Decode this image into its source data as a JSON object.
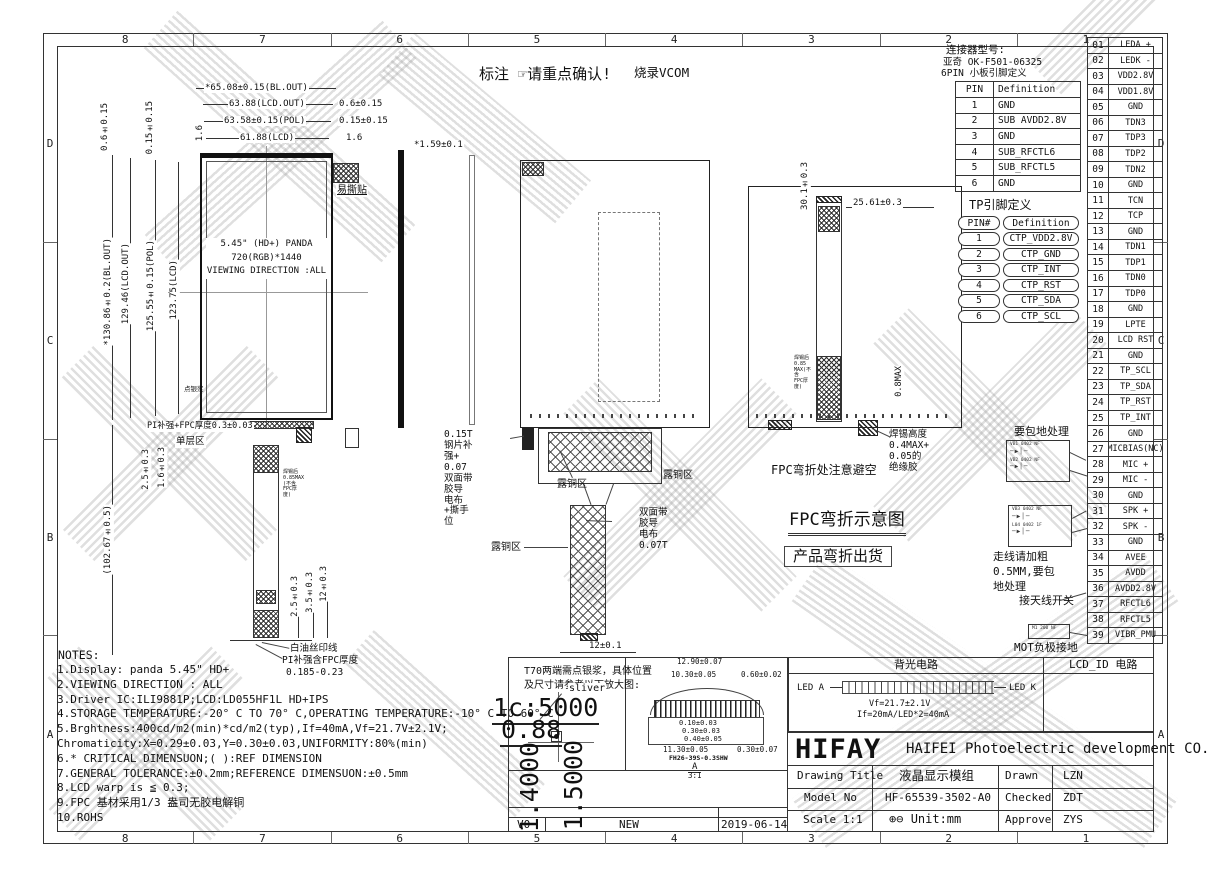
{
  "frame": {
    "cols": [
      "8",
      "7",
      "6",
      "5",
      "4",
      "3",
      "2",
      "1"
    ],
    "rows": [
      "D",
      "C",
      "B",
      "A"
    ]
  },
  "banner": {
    "label": "标注",
    "hand": "☞",
    "confirm": "请重点确认!",
    "vcom": "烧录VCOM"
  },
  "connector": {
    "t1": "连接器型号:",
    "t2": "亚奇 OK-F501-06325",
    "t3": "6PIN 小板引脚定义",
    "h1": "PIN",
    "h2": "Definition",
    "rows": [
      [
        "1",
        "GND"
      ],
      [
        "2",
        "SUB AVDD2.8V"
      ],
      [
        "3",
        "GND"
      ],
      [
        "4",
        "SUB_RFCTL6"
      ],
      [
        "5",
        "SUB_RFCTL5"
      ],
      [
        "6",
        "GND"
      ]
    ]
  },
  "tp": {
    "title": "TP引脚定义",
    "h1": "PIN#",
    "h2": "Definition",
    "rows": [
      [
        "1",
        "CTP_VDD2.8V"
      ],
      [
        "2",
        "CTP_GND"
      ],
      [
        "3",
        "CTP_INT"
      ],
      [
        "4",
        "CTP_RST"
      ],
      [
        "5",
        "CTP_SDA"
      ],
      [
        "6",
        "CTP_SCL"
      ]
    ]
  },
  "pins": {
    "rows": [
      [
        "01",
        "LEDA +"
      ],
      [
        "02",
        "LEDK -"
      ],
      [
        "03",
        "VDD2.8V"
      ],
      [
        "04",
        "VDD1.8V"
      ],
      [
        "05",
        "GND"
      ],
      [
        "06",
        "TDN3"
      ],
      [
        "07",
        "TDP3"
      ],
      [
        "08",
        "TDP2"
      ],
      [
        "09",
        "TDN2"
      ],
      [
        "10",
        "GND"
      ],
      [
        "11",
        "TCN"
      ],
      [
        "12",
        "TCP"
      ],
      [
        "13",
        "GND"
      ],
      [
        "14",
        "TDN1"
      ],
      [
        "15",
        "TDP1"
      ],
      [
        "16",
        "TDN0"
      ],
      [
        "17",
        "TDP0"
      ],
      [
        "18",
        "GND"
      ],
      [
        "19",
        "LPTE"
      ],
      [
        "20",
        "LCD RST"
      ],
      [
        "21",
        "GND"
      ],
      [
        "22",
        "TP_SCL"
      ],
      [
        "23",
        "TP_SDA"
      ],
      [
        "24",
        "TP_RST"
      ],
      [
        "25",
        "TP_INT"
      ],
      [
        "26",
        "GND"
      ],
      [
        "27",
        "MICBIAS(NC)"
      ],
      [
        "28",
        "MIC +"
      ],
      [
        "29",
        "MIC -"
      ],
      [
        "30",
        "GND"
      ],
      [
        "31",
        "SPK +"
      ],
      [
        "32",
        "SPK -"
      ],
      [
        "33",
        "GND"
      ],
      [
        "34",
        "AVEE"
      ],
      [
        "35",
        "AVDD"
      ],
      [
        "36",
        "AVDD2.8V"
      ],
      [
        "37",
        "RFCTL6"
      ],
      [
        "38",
        "RFCTL5"
      ],
      [
        "39",
        "VIBR_PMU"
      ]
    ]
  },
  "rn": {
    "g": "要包地处理",
    "w": "走线请加粗\n0.5MM,要包\n地处理",
    "ant": "接天线开关",
    "mot": "MOT负极接地",
    "c1": "VB1 0402 NF",
    "c2": "VB2 0402 NF",
    "c3": "VB3 0402 NF",
    "c4": "L04 0402 1F",
    "c5": "M1 200 NF",
    "cglyph": "─▶│─"
  },
  "v1": {
    "t1": "*65.08±0.15(BL.OUT)",
    "t2": "63.88(LCD.OUT)",
    "t2r": "0.6±0.15",
    "t3": "63.58±0.15(POL)",
    "t3r": "0.15±0.15",
    "t4": "61.88(LCD)",
    "t4r": "1.6",
    "lv1": "0.6±0.15",
    "lv2": "0.15±0.15",
    "lv3": "1.6",
    "l1": "*130.86±0.2(BL.OUT)",
    "l2": "129.46(LCD.OUT)",
    "l3": "125.55±0.15(POL)",
    "l4": "123.75(LCD)",
    "l5": "(102.67±0.5)",
    "panel1": "5.45\" (HD+) PANDA",
    "panel2": "720(RGB)*1440",
    "panel3": "VIEWING DIRECTION :ALL",
    "sticker": "易撕贴",
    "dot": "点银浆",
    "pi": "PI补强+FPC厚度0.3±0.03",
    "single": "单层区",
    "g1": "1.6±0.3",
    "g2": "2.5±0.3",
    "f1": "12±0.3",
    "f2": "3.5±0.3",
    "f3": "2.5±0.3",
    "silk": "白油丝印线",
    "pith": "PI补强含FPC厚度",
    "pith2": "0.185-0.23",
    "side": "*1.59±0.1",
    "solder_small": "焊锡后0.85MAX\n(不含FPC厚度)"
  },
  "v2": {
    "steel": "0.15T钢片补强+\n0.07双面带胶导\n电布+撕手位",
    "cu": "露铜区",
    "tape": "双面带胶导\n电布0.07T",
    "b": "12±0.1"
  },
  "v3": {
    "d1": "30.1±0.3",
    "d2": "25.61±0.3",
    "d3": "0.8MAX",
    "solder": "焊锡高度0.4MAX+\n0.05的绝缘胶",
    "s2": "焊锡后0.85\nMAX(不含\nFPC厚度)",
    "avoid": "FPC弯折处注意避空",
    "bt": "FPC弯折示意图",
    "bs": "产品弯折出货"
  },
  "notes": {
    "title": "NOTES:",
    "lines": [
      "1.Display: panda 5.45\" HD+",
      "2.VIEWING DIRECTION : ALL",
      "3.Driver IC:ILI9881P;LCD:LD055HF1L HD+IPS",
      "4.STORAGE TEMPERATURE:-20° C TO 70° C,OPERATING TEMPERATURE:-10° C TO 60° C",
      "5.Brghtness:400cd/m2(min)*cd/m2(typ),If=40mA,Vf=21.7V±2.1V;",
      " Chromaticity:X=0.29±0.03,Y=0.30±0.03,UNIFORMITY:80%(min)",
      "6.* CRITICAL DIMENSUON;( ):REF DIMENSION",
      "7.GENERAL TOLERANCE:±0.2mm;REFERENCE DIMENSUON:±0.5mm",
      "8.LCD warp is ≦ 0.3;",
      "9.FPC 基材采用1/3 盎司无胶电解铜",
      "10.ROHS"
    ]
  },
  "mid": {
    "t70": "T70两端需点银浆，具体位置\n及尺寸请参考以下放大图:",
    "sliver": "sliver",
    "s1": "1c:5000",
    "s2": "0.88",
    "s3": "1.4000",
    "s4": "1.5000",
    "rev": "V0",
    "status": "NEW",
    "date": "2019-06-14"
  },
  "detail": {
    "d1": "12.90±0.07",
    "d2": "10.30±0.05",
    "d3": "0.60±0.02",
    "d4": "0.10±0.03",
    "d5": "0.30±0.03",
    "d6": "0.40±0.05",
    "d7": "11.30±0.05",
    "d8": "0.30±0.07",
    "part": "FH26-39S-0.3SHW",
    "view": "A",
    "scale": "3:1"
  },
  "bl": {
    "title": "背光电路",
    "lcd_id": "LCD_ID 电路",
    "leda": "LED A",
    "ledk": "LED K",
    "vf": "Vf=21.7±2.1V",
    "ifr": "If=20mA/LED*2=40mA"
  },
  "tb": {
    "logo": "HIFAY",
    "company": "HAIFEI Photoelectric development CO., LTD",
    "r1l": "Drawing Title",
    "r1v": "液晶显示模组",
    "r1l2": "Drawn",
    "r1v2": "LZN",
    "r2l": "Model No",
    "r2v": "HF-65539-3502-A0",
    "r2l2": "Checked",
    "r2v2": "ZDT",
    "r3l": "Scale 1:1",
    "proj": "⊕⊖",
    "r3v": "Unit:mm",
    "r3l2": "Approve",
    "r3v2": "ZYS"
  }
}
